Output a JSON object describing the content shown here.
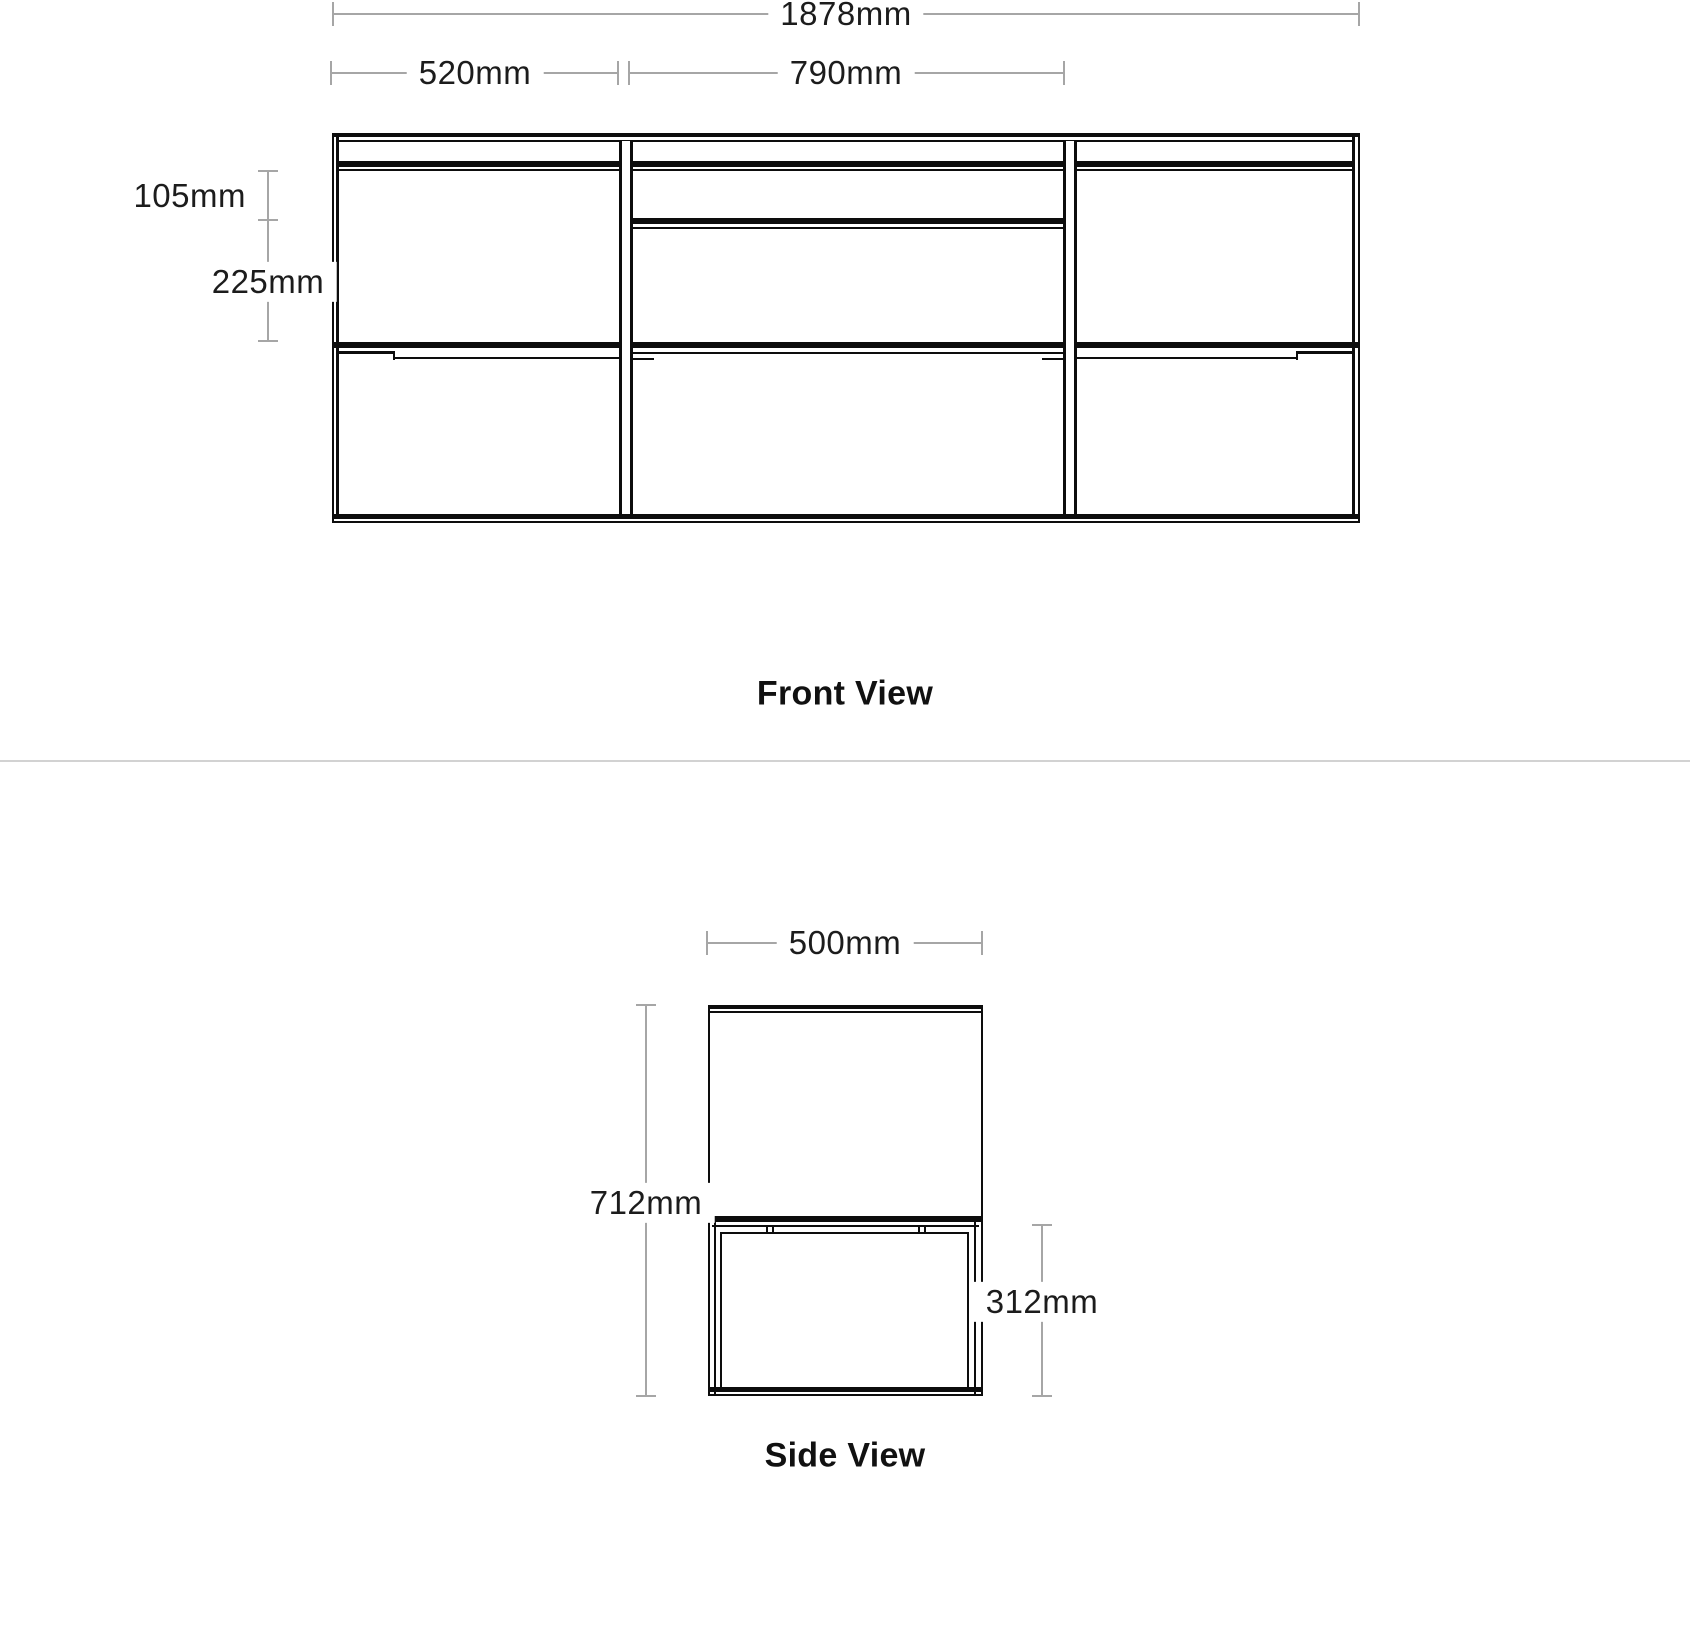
{
  "page": {
    "background": "#ffffff"
  },
  "colors": {
    "drawing_line": "#0d0d0d",
    "dimension_line": "#a6a6a6",
    "text": "#1c1c1c",
    "separator": "#d2d2d2"
  },
  "front_view": {
    "label": "Front View",
    "dims": {
      "total_width": "1878mm",
      "left_section_width": "520mm",
      "center_section_width": "790mm",
      "top_drawer_height": "105mm",
      "lower_drawer_height": "225mm"
    }
  },
  "side_view": {
    "label": "Side View",
    "dims": {
      "depth": "500mm",
      "total_height": "712mm",
      "base_height": "312mm"
    }
  }
}
